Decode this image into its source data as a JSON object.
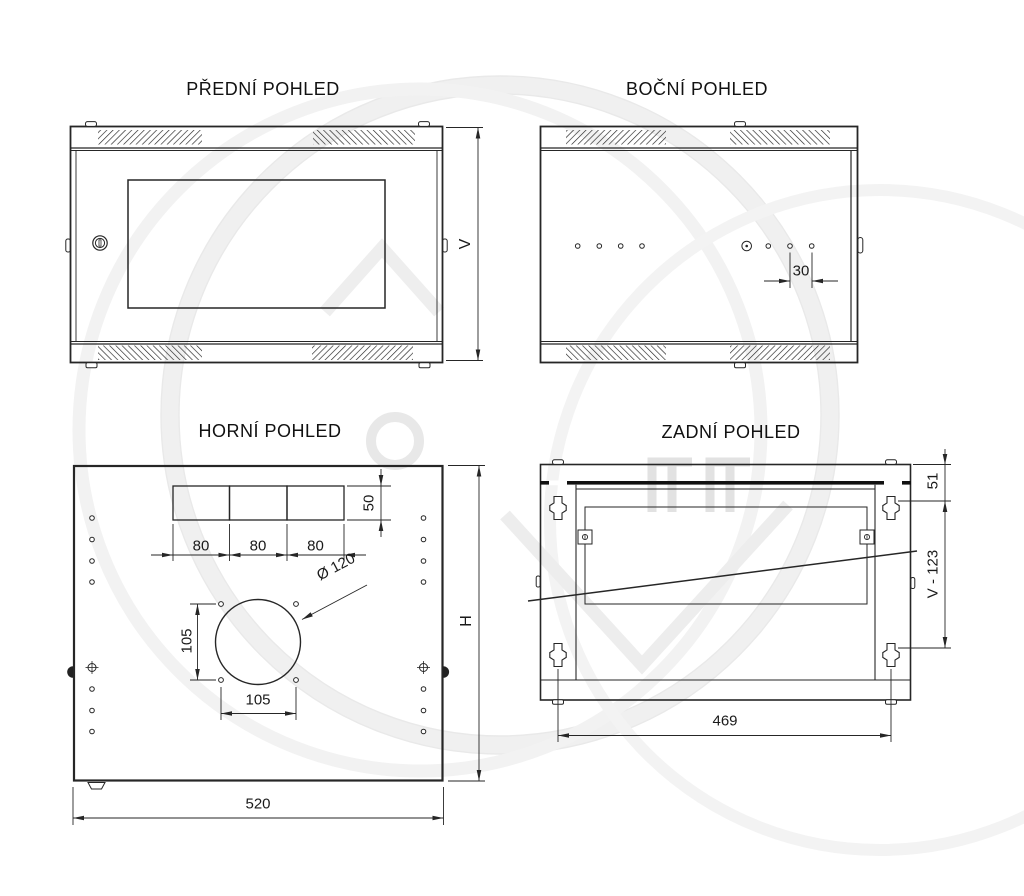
{
  "views": {
    "front": {
      "title": "PŘEDNÍ POHLED",
      "dims": {
        "height": "V"
      }
    },
    "side": {
      "title": "BOČNÍ POHLED",
      "dims": {
        "hole_pitch": "30"
      }
    },
    "top": {
      "title": "HORNÍ POHLED",
      "dims": {
        "slot_height": "50",
        "slot_widths": [
          "80",
          "80",
          "80"
        ],
        "fan_cutout_diameter": "Ø 120",
        "fan_hole_pitch_vertical": "105",
        "fan_hole_pitch_horizontal": "105",
        "overall_width": "520",
        "overall_depth": "H"
      }
    },
    "rear": {
      "title": "ZADNÍ POHLED",
      "dims": {
        "bracket_top_offset": "51",
        "bracket_vertical_pitch": "V - 123",
        "bracket_horizontal_pitch": "469"
      }
    }
  }
}
